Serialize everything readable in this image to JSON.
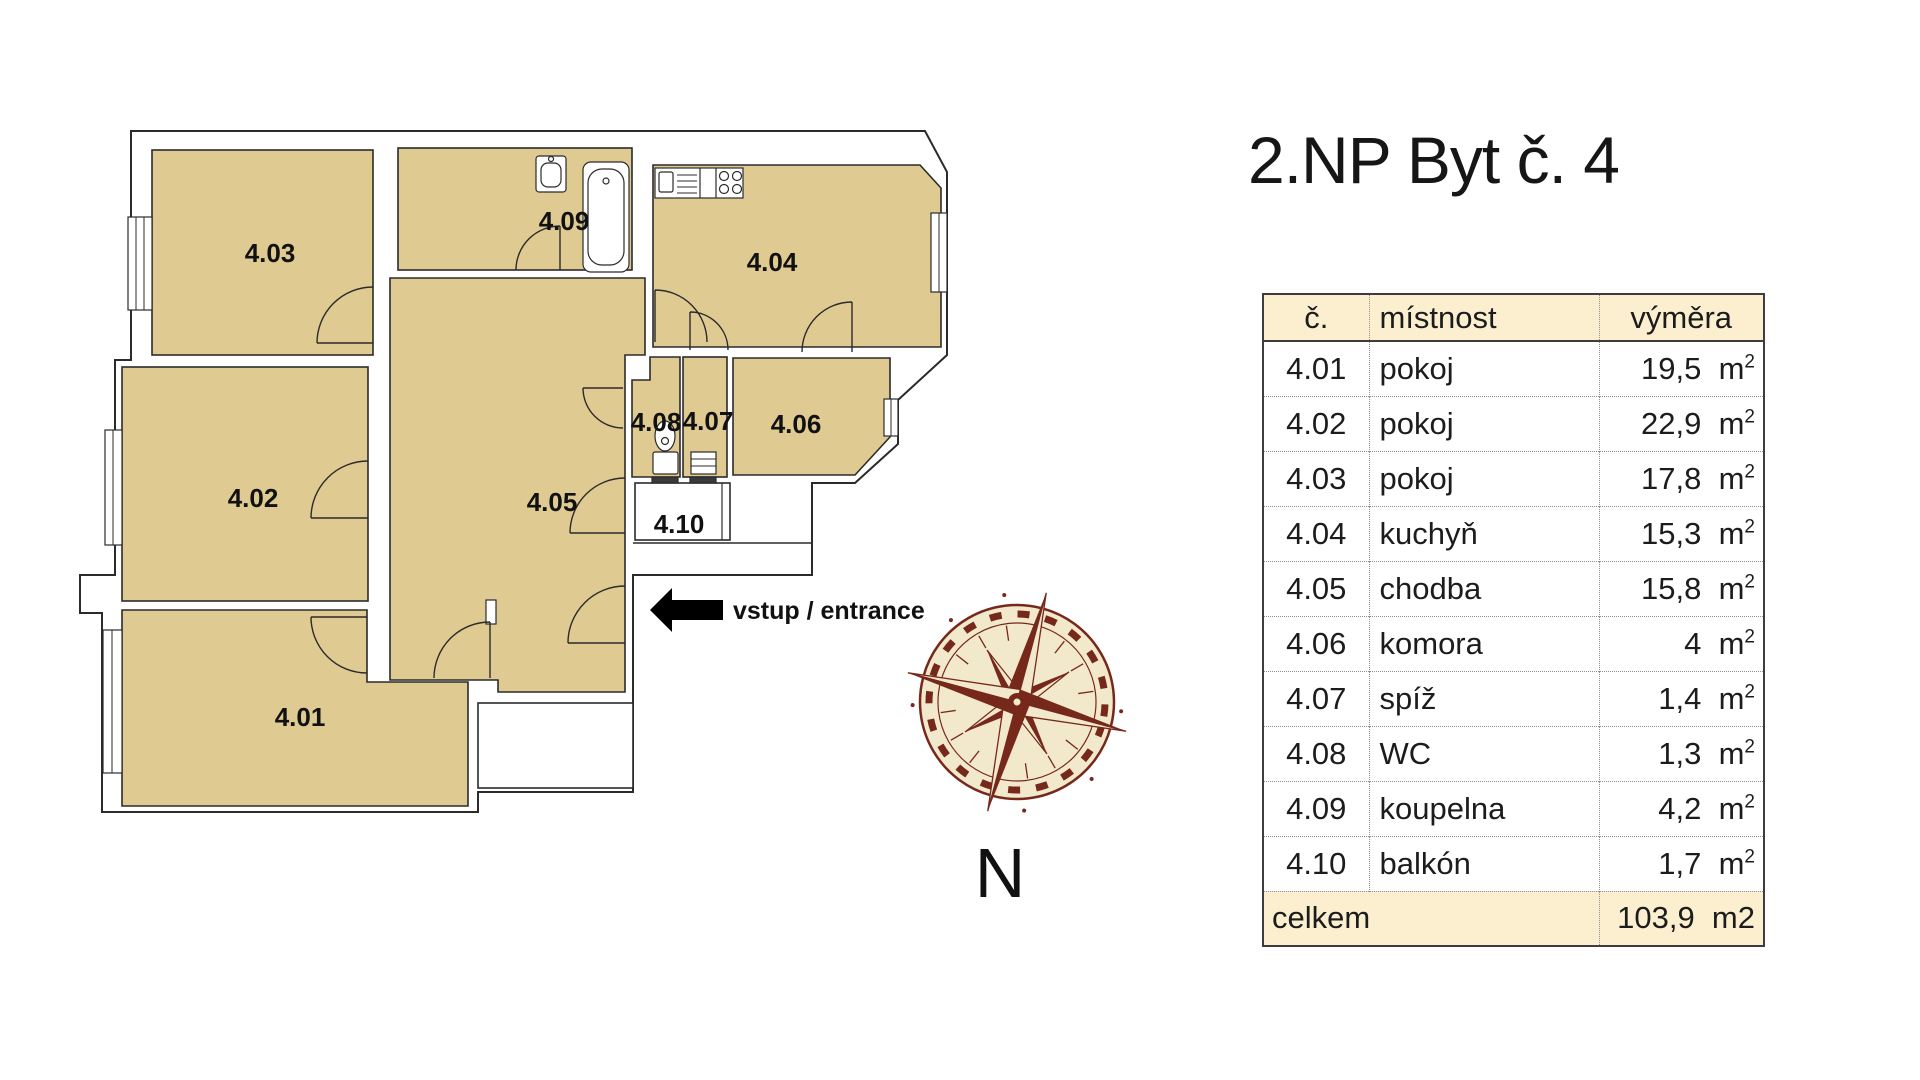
{
  "title": "2.NP Byt č. 4",
  "plan": {
    "room_labels": [
      "4.01",
      "4.02",
      "4.03",
      "4.04",
      "4.05",
      "4.06",
      "4.07",
      "4.08",
      "4.09",
      "4.10"
    ],
    "entrance_label": "vstup / entrance",
    "compass_letter": "N"
  },
  "table": {
    "headers": {
      "number": "č.",
      "room": "místnost",
      "area": "výměra"
    },
    "rows": [
      {
        "number": "4.01",
        "room": "pokoj",
        "area": "19,5",
        "unit": "m",
        "unit_sup": "2"
      },
      {
        "number": "4.02",
        "room": "pokoj",
        "area": "22,9",
        "unit": "m",
        "unit_sup": "2"
      },
      {
        "number": "4.03",
        "room": "pokoj",
        "area": "17,8",
        "unit": "m",
        "unit_sup": "2"
      },
      {
        "number": "4.04",
        "room": "kuchyň",
        "area": "15,3",
        "unit": "m",
        "unit_sup": "2"
      },
      {
        "number": "4.05",
        "room": "chodba",
        "area": "15,8",
        "unit": "m",
        "unit_sup": "2"
      },
      {
        "number": "4.06",
        "room": "komora",
        "area": "4",
        "unit": "m",
        "unit_sup": "2"
      },
      {
        "number": "4.07",
        "room": "spíž",
        "area": "1,4",
        "unit": "m",
        "unit_sup": "2"
      },
      {
        "number": "4.08",
        "room": "WC",
        "area": "1,3",
        "unit": "m",
        "unit_sup": "2"
      },
      {
        "number": "4.09",
        "room": "koupelna",
        "area": "4,2",
        "unit": "m",
        "unit_sup": "2"
      },
      {
        "number": "4.10",
        "room": "balkón",
        "area": "1,7",
        "unit": "m",
        "unit_sup": "2"
      }
    ],
    "footer": {
      "label": "celkem",
      "area": "103,9",
      "unit": "m2"
    }
  },
  "colors": {
    "room_fill": "#dfca92",
    "wall": "#2b2b2b",
    "table_header_bg": "#fbefd0",
    "compass_brown": "#76281a",
    "compass_cream": "#f2e9cd"
  }
}
